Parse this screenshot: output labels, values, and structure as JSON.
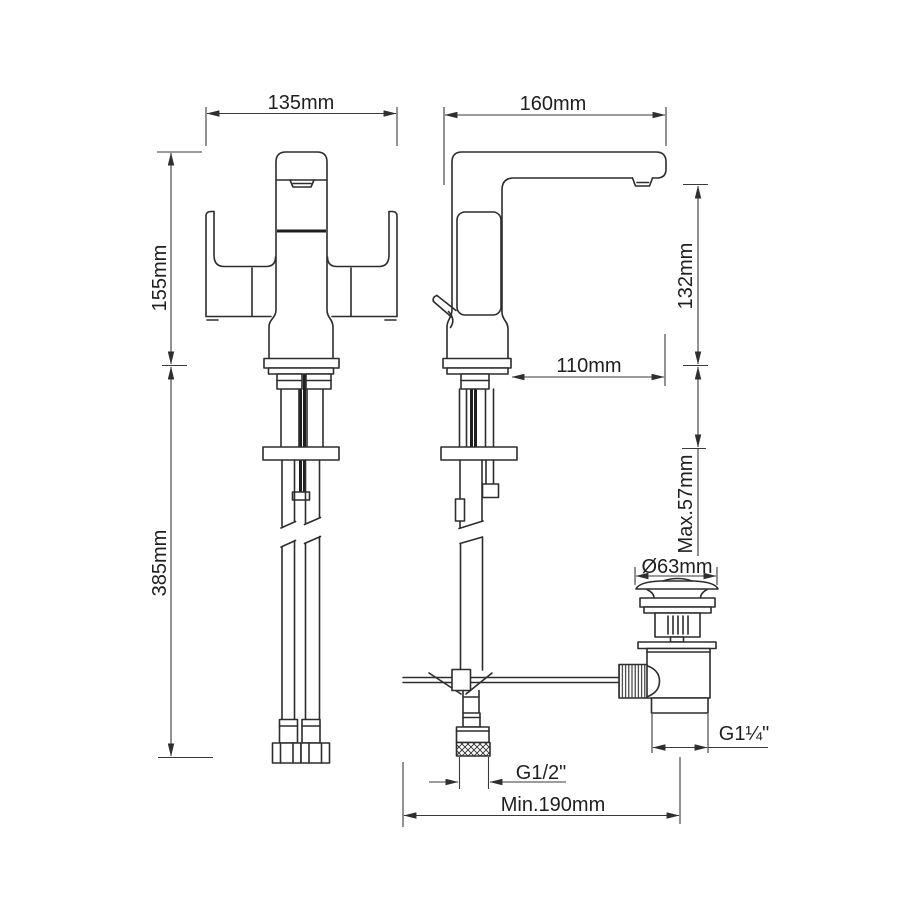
{
  "drawing": {
    "type": "technical-dimension-drawing",
    "subject": "twin-lever basin mixer tap with pop-up waste",
    "colors": {
      "background": "#ffffff",
      "line": "#2d2d2d",
      "dimension": "#3a3a3a"
    },
    "dimensions": {
      "front_width": "135mm",
      "depth": "160mm",
      "body_height": "155mm",
      "hose_length": "385mm",
      "spout_reach": "110mm",
      "spout_height": "132mm",
      "max_deck_thickness": "Max.57mm",
      "waste_flange_diameter": "Ø63mm",
      "inlet_thread": "G1/2\"",
      "waste_thread": "G1¼\"",
      "min_rod_distance": "Min.190mm"
    }
  }
}
